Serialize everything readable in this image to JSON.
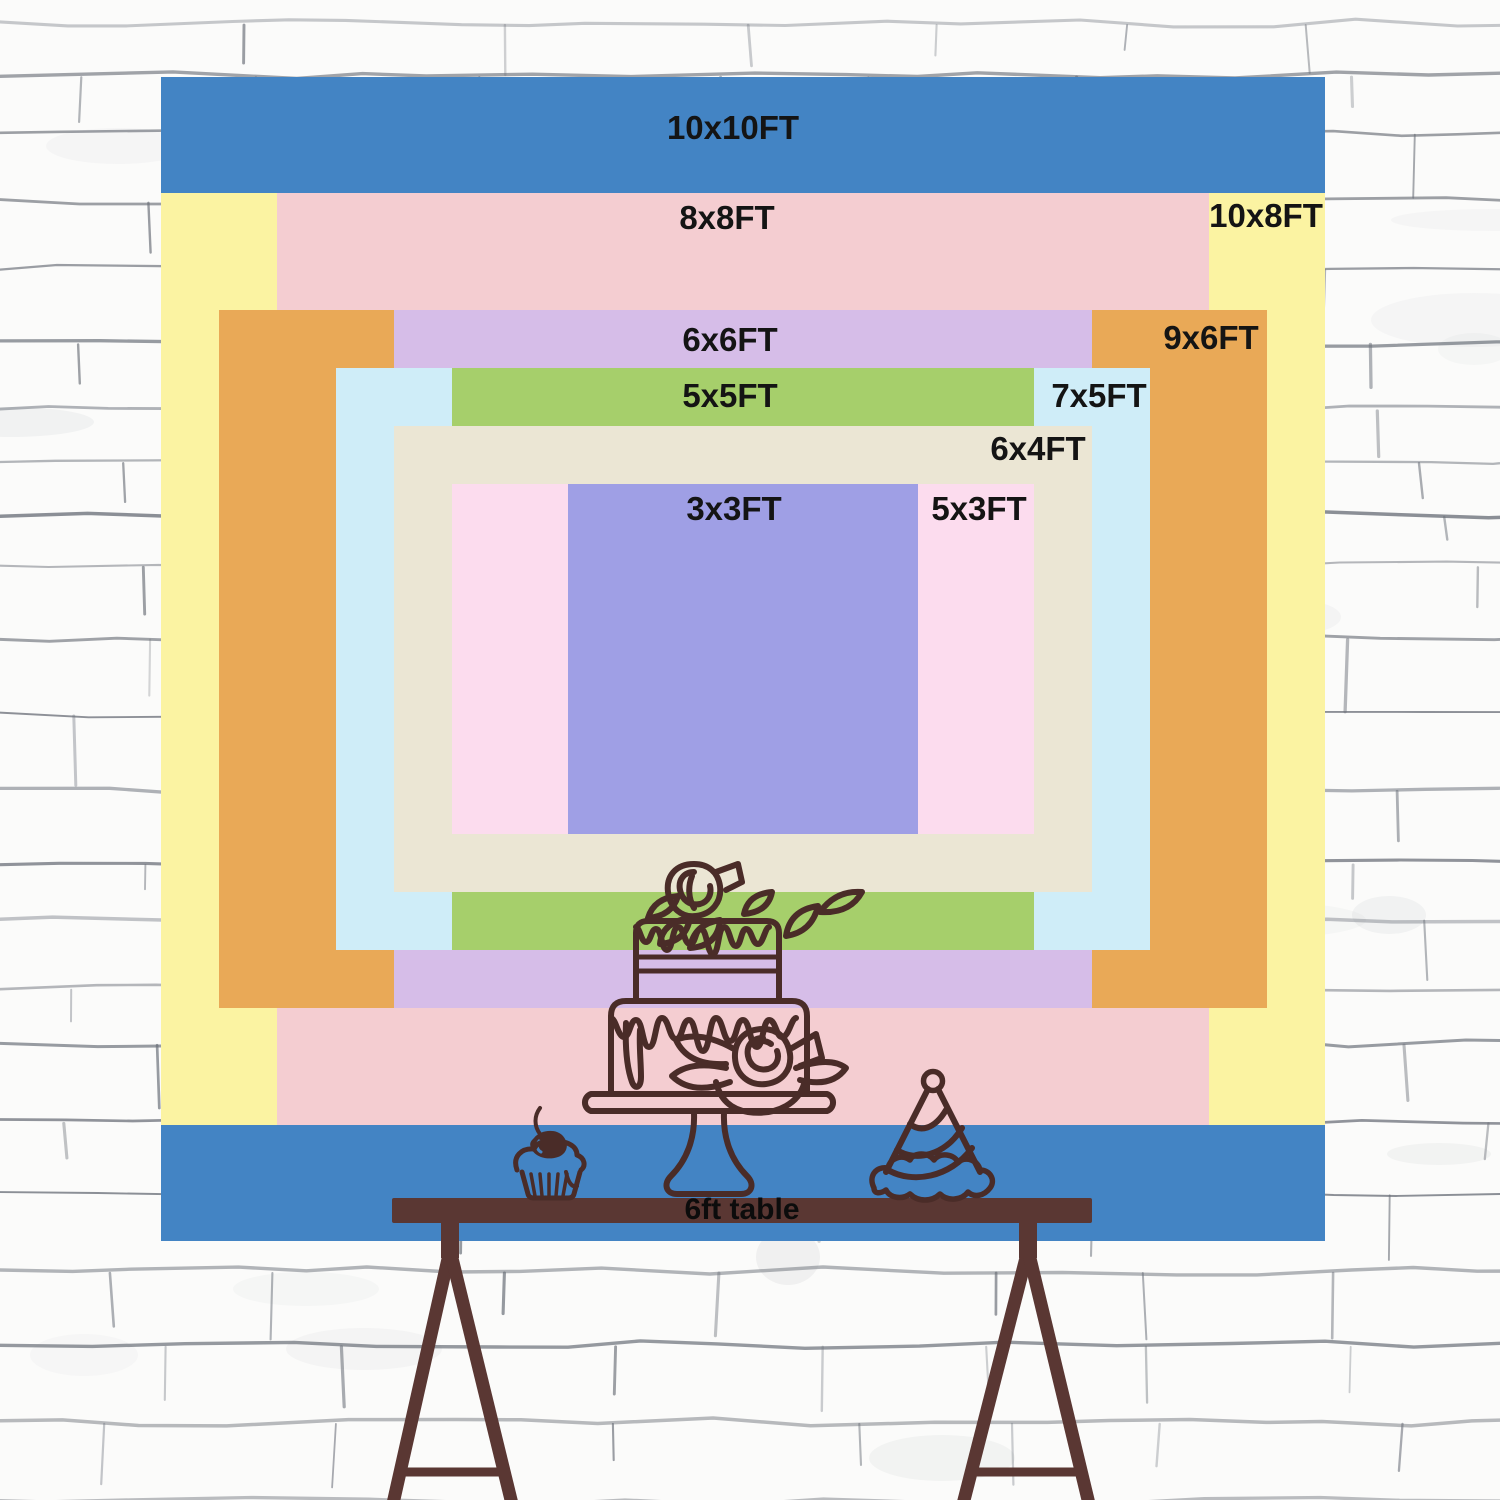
{
  "chart": {
    "unit_suffix": "FT",
    "sizes": [
      {
        "id": "10x10ft",
        "label": "10x10FT",
        "width_ft": 10,
        "height_ft": 10,
        "color": "#4384c4"
      },
      {
        "id": "10x8ft",
        "label": "10x8FT",
        "width_ft": 10,
        "height_ft": 8,
        "color": "#fbf3a2"
      },
      {
        "id": "8x8ft",
        "label": "8x8FT",
        "width_ft": 8,
        "height_ft": 8,
        "color": "#f4cdd1"
      },
      {
        "id": "9x6ft",
        "label": "9x6FT",
        "width_ft": 9,
        "height_ft": 6,
        "color": "#e9a957"
      },
      {
        "id": "6x6ft",
        "label": "6x6FT",
        "width_ft": 6,
        "height_ft": 6,
        "color": "#d6bde8"
      },
      {
        "id": "7x5ft",
        "label": "7x5FT",
        "width_ft": 7,
        "height_ft": 5,
        "color": "#cfedf8"
      },
      {
        "id": "5x5ft",
        "label": "5x5FT",
        "width_ft": 5,
        "height_ft": 5,
        "color": "#a6cf6b"
      },
      {
        "id": "6x4ft",
        "label": "6x4FT",
        "width_ft": 6,
        "height_ft": 4,
        "color": "#ebe6d4"
      },
      {
        "id": "5x3ft",
        "label": "5x3FT",
        "width_ft": 5,
        "height_ft": 3,
        "color": "#fcdcee"
      },
      {
        "id": "3x3ft",
        "label": "3x3FT",
        "width_ft": 3,
        "height_ft": 3,
        "color": "#9f9fe5"
      }
    ]
  },
  "table": {
    "label": "6ft table",
    "wood_color": "#5a3733"
  },
  "art": {
    "outline_color": "#4a2c28",
    "cherry_highlight_color": "#4384c4"
  },
  "wall": {
    "base_color": "#fbfbfa",
    "mortar_line_color": "#6a6f78"
  }
}
